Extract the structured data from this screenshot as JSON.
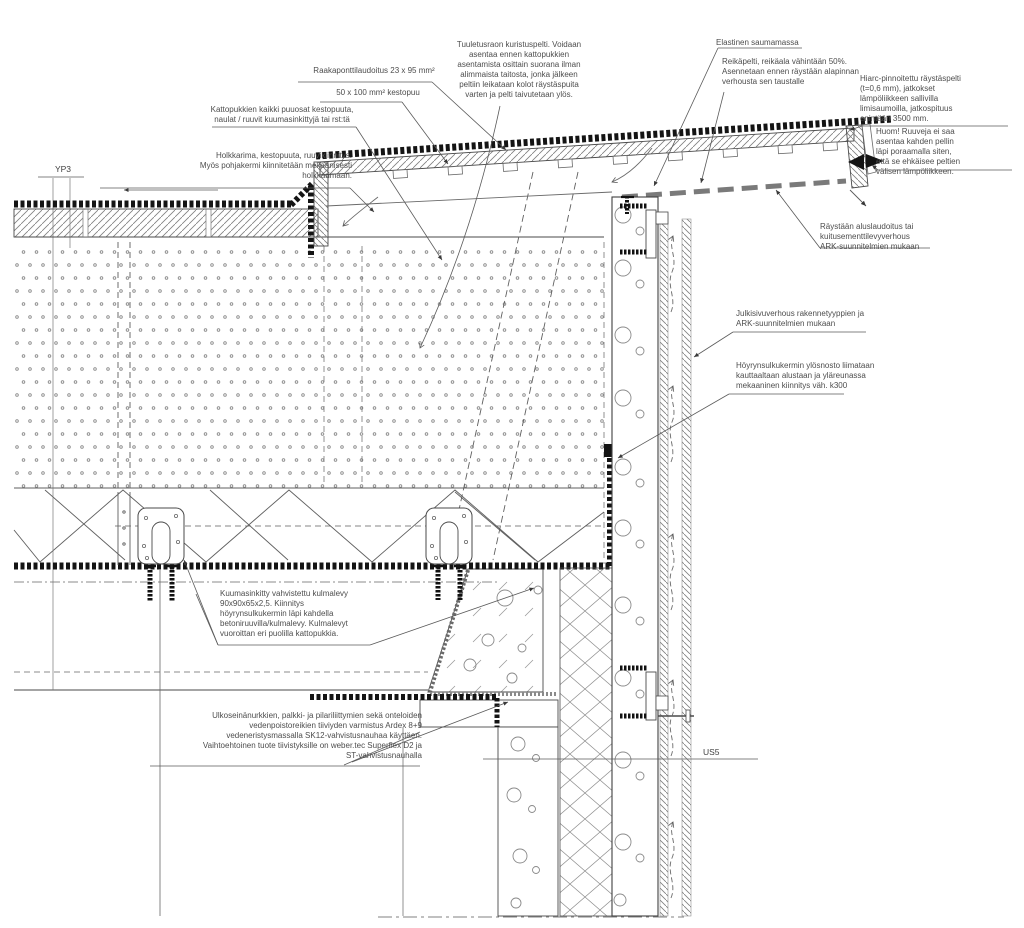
{
  "drawing": {
    "type": "construction-detail-section",
    "colors": {
      "line": "#3a3a3a",
      "membrane": "#141414",
      "pattern": "#8a8a8a",
      "text": "#4d4d4d",
      "background": "#ffffff"
    },
    "reference_marks": {
      "roof_type": {
        "text": "YP3"
      },
      "wall_type": {
        "text": "US5"
      }
    },
    "labels": {
      "raakapontti": {
        "text": "Raakaponttilaudoitus 23 x 95 mm²"
      },
      "kestopuu50": {
        "text": "50 x 100 mm² kestopuu"
      },
      "kattopukit": {
        "text": "Kattopukkien kaikki puuosat kestopuuta,\nnaulat / ruuvit kuumasinkittyjä tai rst:tä"
      },
      "holkkarima": {
        "text": "Holkkarima, kestopuuta, ruuvikiinnitys.\nMyös pohjakermi kiinnitetään mekaanisesti\nholkkarimaan."
      },
      "kuristuspelti": {
        "text": "Tuuletusraon kuristuspelti. Voidaan\nasentaa ennen kattopukkien\nasentamista osittain suorana ilman\nalimmaista taitosta, jonka jälkeen\npeltiin leikataan kolot räystäspuita\nvarten ja pelti taivutetaan ylös."
      },
      "elastinen": {
        "text": "Elastinen saumamassa"
      },
      "reikapelti": {
        "text": "Reikäpelti, reikäala vähintään 50%.\nAsennetaan ennen räystään alapinnan\nverhousta sen taustalle"
      },
      "hiarc": {
        "text": "Hiarc-pinnoitettu räystäspelti\n(t=0,6 mm), jatkokset\nlämpöliikkeen sallivilla\nlimisaumoilla, jatkospituus\nenintään 3500 mm."
      },
      "huom": {
        "text": "Huom! Ruuveja ei saa\nasentaa kahden pellin\nläpi poraamalla siten,\nettä se ehkäisee peltien\nvälisen lämpöliikkeen."
      },
      "aluslaudoitus": {
        "text": "Räystään aluslaudoitus tai\nkuitusementtilevyverhous\nARK-suunnitelmien mukaan"
      },
      "julkisivu": {
        "text": "Julkisivuverhous rakennetyyppien ja\nARK-suunnitelmien mukaan"
      },
      "hoyrynsulku": {
        "text": "Höyrynsulkukermin ylösnosto liimataan\nkauttaaltaan alustaan ja yläreunassa\nmekaaninen kiinnitys väh. k300"
      },
      "kulmalevy": {
        "text": "Kuumasinkitty vahvistettu kulmalevy\n90x90x65x2,5. Kiinnitys\nhöyrynsulkukermin läpi kahdella\nbetoniruuvilla/kulmalevy. Kulmalevyt\nvuoroittan eri puolilla kattopukkia."
      },
      "ardex": {
        "text": "Ulkoseinänurkkien, palkki- ja pilariliittymien sekä onteloiden\nvedenpoistoreikien tiiviyden varmistus Ardex 8+9\nvedeneristysmassalla SK12-vahvistusnauhaa käyttäen.\nVaihtoehtoinen tuote tiivistyksille on weber.tec Superflex D2 ja\nST-vahvistusnauhalla"
      }
    }
  }
}
